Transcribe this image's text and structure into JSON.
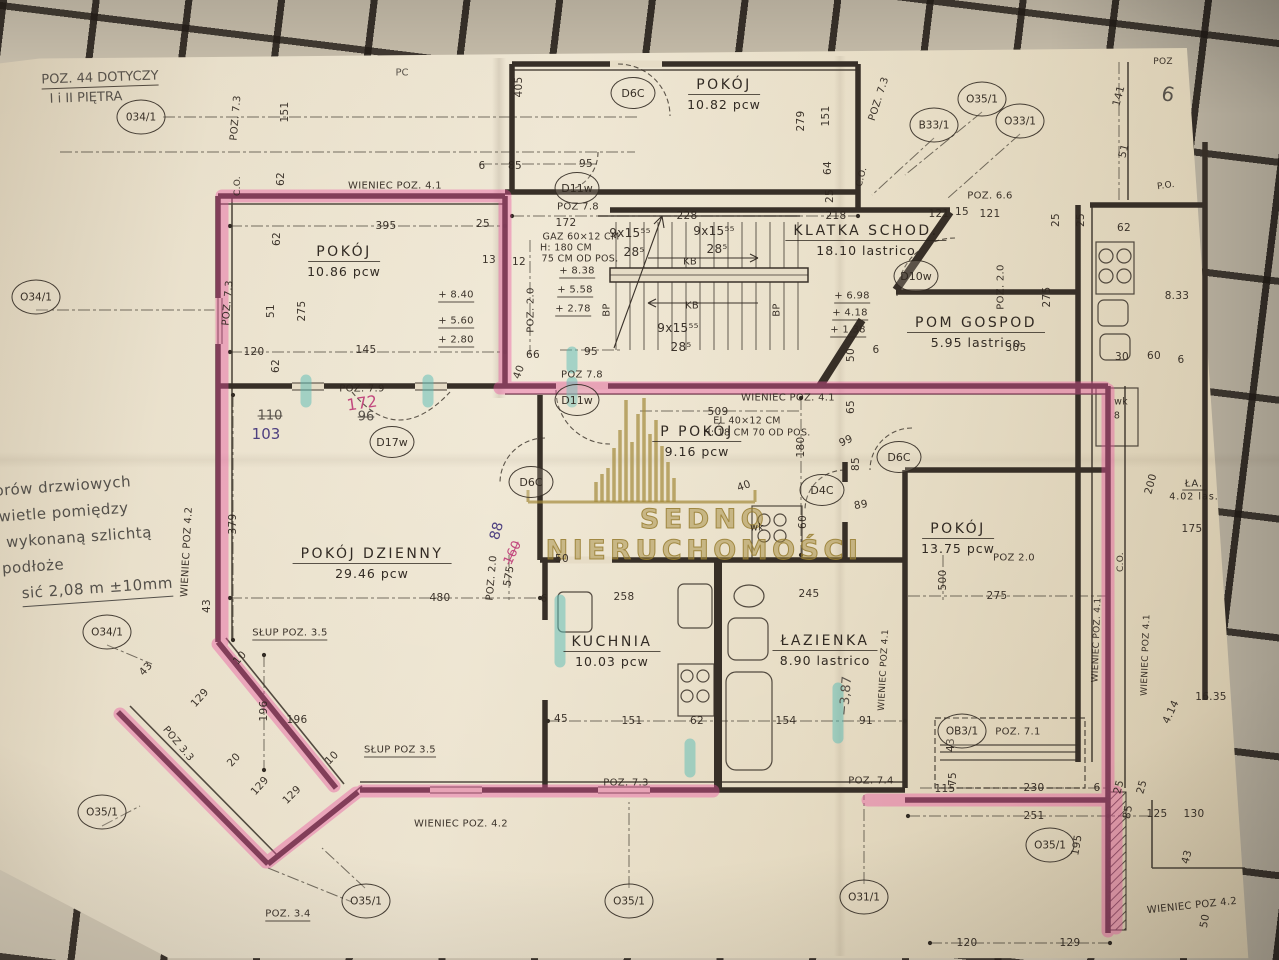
{
  "photo": {
    "paper_color": "#e6dcc6",
    "ink_color": "#332c24",
    "highlighter_pink": "#e954a0",
    "highlighter_teal": "#58bcb6",
    "watermark_gold": "#a58c3e",
    "cloth_color": "#d2c8b4"
  },
  "watermark": {
    "text": "SEDNO NIERUCHOMOŚCI",
    "icon": "building-skyline-icon"
  },
  "note_top": {
    "line1": "POZ. 44 DOTYCZY",
    "line2": "I i II PIĘTRA"
  },
  "margin_note": {
    "lines": [
      "orów drzwiowych",
      "świetle pomiędzy",
      "wykonaną szlichtą",
      "podłoże",
      "sić 2,08 m ±10mm"
    ],
    "indents": [
      6,
      0,
      14,
      8,
      26
    ]
  },
  "rooms": [
    {
      "name": "POKÓJ",
      "area": "10.82 pcw",
      "x": 724,
      "y": 93
    },
    {
      "name": "POKÓJ",
      "area": "10.86 pcw",
      "x": 344,
      "y": 260
    },
    {
      "name": "KLATKA SCHOD.",
      "area": "18.10 lastrico",
      "x": 866,
      "y": 239
    },
    {
      "name": "POM GOSPOD",
      "area": "5.95 lastrico",
      "x": 976,
      "y": 331
    },
    {
      "name": "P POKÓJ",
      "area": "9.16 pcw",
      "x": 697,
      "y": 440
    },
    {
      "name": "POKÓJ DZIENNY",
      "area": "29.46 pcw",
      "x": 372,
      "y": 562
    },
    {
      "name": "KUCHNIA",
      "area": "10.03 pcw",
      "x": 612,
      "y": 650
    },
    {
      "name": "ŁAZIENKA",
      "area": "8.90 lastrico",
      "x": 825,
      "y": 649
    },
    {
      "name": "POKÓJ",
      "area": "13.75 pcw",
      "x": 958,
      "y": 537
    },
    {
      "name": "ŁA.",
      "area": "4.02 las.",
      "x": 1194,
      "y": 487,
      "small": 1
    }
  ],
  "door_symbols": [
    {
      "label": "D6C",
      "x": 633,
      "y": 93
    },
    {
      "label": "D11w",
      "x": 577,
      "y": 188
    },
    {
      "label": "D10w",
      "x": 916,
      "y": 276
    },
    {
      "label": "D11w",
      "x": 577,
      "y": 400
    },
    {
      "label": "D17w",
      "x": 392,
      "y": 442
    },
    {
      "label": "D6C",
      "x": 531,
      "y": 482
    },
    {
      "label": "D4C",
      "x": 822,
      "y": 490
    },
    {
      "label": "D6C",
      "x": 899,
      "y": 457
    }
  ],
  "ref_symbols": [
    {
      "label": "034/1",
      "x": 141,
      "y": 117
    },
    {
      "label": "O34/1",
      "x": 36,
      "y": 297
    },
    {
      "label": "B33/1",
      "x": 934,
      "y": 125
    },
    {
      "label": "O35/1",
      "x": 982,
      "y": 99
    },
    {
      "label": "O33/1",
      "x": 1020,
      "y": 121
    },
    {
      "label": "O34/1",
      "x": 107,
      "y": 632
    },
    {
      "label": "O35/1",
      "x": 102,
      "y": 812
    },
    {
      "label": "O35/1",
      "x": 366,
      "y": 901
    },
    {
      "label": "O35/1",
      "x": 629,
      "y": 901
    },
    {
      "label": "O31/1",
      "x": 864,
      "y": 897
    },
    {
      "label": "OB3/1",
      "x": 962,
      "y": 731
    },
    {
      "label": "O35/1",
      "x": 1050,
      "y": 845
    }
  ],
  "annotations": [
    {
      "t": "WIENIEC POZ. 4.1",
      "x": 395,
      "y": 186
    },
    {
      "t": "WIENIEC POZ. 4.1",
      "x": 788,
      "y": 398
    },
    {
      "t": "WIENIEC POZ. 4.2",
      "x": 461,
      "y": 824
    },
    {
      "t": "WIENIEC POZ 4.2",
      "x": 187,
      "y": 552,
      "r": -87
    },
    {
      "t": "WIENIEC POZ 4.1",
      "x": 884,
      "y": 670,
      "r": -87,
      "fs": 9
    },
    {
      "t": "WIENIEC POZ. 4.1",
      "x": 1097,
      "y": 640,
      "r": -88,
      "fs": 9
    },
    {
      "t": "WIENIEC POZ 4.1",
      "x": 1146,
      "y": 655,
      "r": -88,
      "fs": 9
    },
    {
      "t": "WIENIEC POZ 4.2",
      "x": 1192,
      "y": 906,
      "r": -6
    },
    {
      "t": "POZ 7.8",
      "x": 578,
      "y": 207
    },
    {
      "t": "POZ 7.8",
      "x": 582,
      "y": 375
    },
    {
      "t": "POZ. 7.9",
      "x": 362,
      "y": 389
    },
    {
      "t": "POZ. 7.3",
      "x": 236,
      "y": 118,
      "r": -85
    },
    {
      "t": "POZ. 7.3",
      "x": 228,
      "y": 303,
      "r": -85
    },
    {
      "t": "POZ. 7.3",
      "x": 879,
      "y": 99,
      "r": -72
    },
    {
      "t": "POZ. 7.3",
      "x": 626,
      "y": 783
    },
    {
      "t": "POZ. 7.4",
      "x": 871,
      "y": 781
    },
    {
      "t": "POZ. 7.1",
      "x": 1018,
      "y": 732
    },
    {
      "t": "POZ. 6.6",
      "x": 990,
      "y": 196
    },
    {
      "t": "POZ. 2.0",
      "x": 531,
      "y": 310,
      "r": -90
    },
    {
      "t": "POZ. 2.0",
      "x": 1001,
      "y": 287,
      "r": -90
    },
    {
      "t": "POZ 2.0",
      "x": 1014,
      "y": 558
    },
    {
      "t": "POZ. 2.0",
      "x": 492,
      "y": 578,
      "r": -85
    },
    {
      "t": "SŁUP POZ. 3.5",
      "x": 290,
      "y": 634,
      "u": 1
    },
    {
      "t": "SŁUP POZ 3.5",
      "x": 400,
      "y": 751,
      "u": 1
    },
    {
      "t": "POZ 3.3",
      "x": 178,
      "y": 744,
      "r": 50
    },
    {
      "t": "POZ. 3.4",
      "x": 288,
      "y": 915,
      "u": 1
    },
    {
      "t": "GAZ 60×12 CM",
      "x": 581,
      "y": 237,
      "fs": 9.5
    },
    {
      "t": "H: 180 CM",
      "x": 566,
      "y": 248,
      "fs": 9.5
    },
    {
      "t": "75 CM OD POS.",
      "x": 580,
      "y": 259,
      "fs": 9.5
    },
    {
      "t": "EL 40×12 CM",
      "x": 747,
      "y": 421,
      "fs": 9.5
    },
    {
      "t": "H: 18 CM 70 OD POS.",
      "x": 757,
      "y": 433,
      "fs": 9.5
    },
    {
      "t": "+ 8.40",
      "x": 456,
      "y": 296,
      "u": 1
    },
    {
      "t": "+ 5.60",
      "x": 456,
      "y": 322,
      "u": 1
    },
    {
      "t": "+ 2.80",
      "x": 456,
      "y": 341,
      "u": 1
    },
    {
      "t": "+ 8.38",
      "x": 577,
      "y": 272,
      "u": 1
    },
    {
      "t": "+ 5.58",
      "x": 575,
      "y": 291,
      "u": 1
    },
    {
      "t": "+ 2.78",
      "x": 573,
      "y": 310,
      "u": 1
    },
    {
      "t": "+ 6.98",
      "x": 852,
      "y": 297,
      "u": 1
    },
    {
      "t": "+ 4.18",
      "x": 850,
      "y": 314,
      "u": 1
    },
    {
      "t": "+ 1.38",
      "x": 848,
      "y": 331,
      "u": 1
    },
    {
      "t": "9x15⁵⁵",
      "x": 630,
      "y": 233,
      "fs": 12
    },
    {
      "t": "9x15⁵⁵",
      "x": 714,
      "y": 231,
      "fs": 12
    },
    {
      "t": "9x15⁵⁵",
      "x": 678,
      "y": 328,
      "fs": 12
    },
    {
      "t": "28⁵",
      "x": 634,
      "y": 252,
      "fs": 12
    },
    {
      "t": "28⁵",
      "x": 717,
      "y": 249,
      "fs": 12
    },
    {
      "t": "28⁵",
      "x": 681,
      "y": 347,
      "fs": 12
    },
    {
      "t": "KB",
      "x": 690,
      "y": 262
    },
    {
      "t": "KB",
      "x": 692,
      "y": 306
    },
    {
      "t": "BP",
      "x": 607,
      "y": 310,
      "r": -90
    },
    {
      "t": "BP",
      "x": 777,
      "y": 310,
      "r": -90
    },
    {
      "t": "C.O.",
      "x": 238,
      "y": 186,
      "r": -90,
      "fs": 9
    },
    {
      "t": "C.O.",
      "x": 862,
      "y": 177,
      "r": -75,
      "fs": 9
    },
    {
      "t": "C.O.",
      "x": 1121,
      "y": 562,
      "r": -90,
      "fs": 9
    },
    {
      "t": "P.O.",
      "x": 1166,
      "y": 186,
      "r": -8,
      "fs": 9
    },
    {
      "t": "POZ",
      "x": 1163,
      "y": 62,
      "fs": 9
    },
    {
      "t": "wk",
      "x": 1121,
      "y": 402,
      "fs": 9.5
    },
    {
      "t": "8",
      "x": 1117,
      "y": 416,
      "fs": 9.5
    },
    {
      "t": "wk",
      "x": 757,
      "y": 528,
      "fs": 9.5
    }
  ],
  "dims": [
    [
      "405",
      519,
      87,
      -90
    ],
    [
      "6",
      482,
      166
    ],
    [
      "85",
      515,
      166
    ],
    [
      "95",
      586,
      164
    ],
    [
      "172",
      566,
      223
    ],
    [
      "228",
      687,
      216
    ],
    [
      "218",
      836,
      216
    ],
    [
      "279",
      801,
      121,
      -90
    ],
    [
      "151",
      826,
      116,
      -90
    ],
    [
      "64",
      828,
      168,
      -90
    ],
    [
      "25",
      830,
      196,
      -90
    ],
    [
      "121",
      939,
      214
    ],
    [
      "15",
      962,
      212
    ],
    [
      "121",
      990,
      214
    ],
    [
      "25",
      1056,
      220,
      -90
    ],
    [
      "25",
      1081,
      220,
      -90
    ],
    [
      "62",
      1124,
      228
    ],
    [
      "141",
      1119,
      96,
      -75
    ],
    [
      "51",
      1124,
      151,
      -75
    ],
    [
      "151",
      285,
      112,
      -90
    ],
    [
      "62",
      281,
      179,
      -90
    ],
    [
      "395",
      386,
      226
    ],
    [
      "25",
      483,
      224
    ],
    [
      "62",
      277,
      239,
      -90
    ],
    [
      "13",
      489,
      260
    ],
    [
      "12",
      519,
      262
    ],
    [
      "51",
      271,
      311,
      -90
    ],
    [
      "275",
      302,
      311,
      -90
    ],
    [
      "145",
      366,
      350
    ],
    [
      "120",
      254,
      352
    ],
    [
      "62",
      276,
      366,
      -90
    ],
    [
      "95",
      591,
      352
    ],
    [
      "66",
      533,
      355
    ],
    [
      "40",
      519,
      372,
      -70
    ],
    [
      "509",
      718,
      412
    ],
    [
      "65",
      851,
      407,
      -90
    ],
    [
      "99",
      846,
      441,
      -25
    ],
    [
      "180",
      801,
      447,
      -90
    ],
    [
      "85",
      856,
      464,
      -90
    ],
    [
      "40",
      744,
      486,
      -20
    ],
    [
      "89",
      861,
      505,
      -10
    ],
    [
      "60",
      803,
      522,
      -90
    ],
    [
      "379",
      233,
      524,
      -90
    ],
    [
      "480",
      440,
      598
    ],
    [
      "575",
      509,
      576,
      -80
    ],
    [
      "50",
      562,
      559
    ],
    [
      "6",
      544,
      599
    ],
    [
      "258",
      624,
      597
    ],
    [
      "245",
      809,
      594
    ],
    [
      "45",
      561,
      719
    ],
    [
      "151",
      632,
      721
    ],
    [
      "62",
      697,
      721
    ],
    [
      "154",
      786,
      721
    ],
    [
      "91",
      866,
      721
    ],
    [
      "196",
      264,
      711,
      -90
    ],
    [
      "196",
      297,
      720
    ],
    [
      "129",
      200,
      698,
      -48
    ],
    [
      "43",
      146,
      669,
      -48
    ],
    [
      "10",
      240,
      658,
      -48
    ],
    [
      "20",
      234,
      760,
      -48
    ],
    [
      "10",
      332,
      758,
      -45
    ],
    [
      "129",
      260,
      786,
      -48
    ],
    [
      "129",
      292,
      795,
      -45
    ],
    [
      "275",
      997,
      596
    ],
    [
      "500",
      943,
      580,
      -90
    ],
    [
      "275",
      1047,
      297,
      -90
    ],
    [
      "305",
      1016,
      348
    ],
    [
      "50",
      851,
      355,
      -90
    ],
    [
      "6",
      876,
      350
    ],
    [
      "30",
      1122,
      357
    ],
    [
      "60",
      1154,
      356
    ],
    [
      "6",
      1181,
      360
    ],
    [
      "230",
      1034,
      788
    ],
    [
      "251",
      1034,
      816
    ],
    [
      "6",
      1097,
      788
    ],
    [
      "25",
      1119,
      787,
      -75
    ],
    [
      "25",
      1142,
      787,
      -75
    ],
    [
      "115",
      945,
      789
    ],
    [
      "75",
      953,
      779,
      -90
    ],
    [
      "43",
      951,
      745,
      -90
    ],
    [
      "85",
      1128,
      812,
      -80
    ],
    [
      "125",
      1157,
      814
    ],
    [
      "130",
      1194,
      814
    ],
    [
      "120",
      967,
      943
    ],
    [
      "129",
      1070,
      943
    ],
    [
      "195",
      1077,
      845,
      -80
    ],
    [
      "43",
      1187,
      857,
      -75
    ],
    [
      "50",
      1205,
      921,
      -80
    ],
    [
      "175",
      1192,
      529
    ],
    [
      "200",
      1151,
      484,
      -75
    ],
    [
      "43",
      207,
      606,
      -90
    ],
    [
      "8.33",
      1177,
      296
    ],
    [
      "16.35",
      1211,
      697
    ],
    [
      "4.14",
      1171,
      712,
      -65
    ]
  ],
  "hand_marks": [
    {
      "t": "110",
      "x": 270,
      "y": 416,
      "c": "pencil",
      "strike": 1
    },
    {
      "t": "103",
      "x": 266,
      "y": 434,
      "c": "purple",
      "fs": 15
    },
    {
      "t": "172",
      "x": 362,
      "y": 403,
      "c": "pinkpen",
      "fs": 16,
      "r": -8
    },
    {
      "t": "96",
      "x": 366,
      "y": 417,
      "c": "pencil",
      "strike": 1
    },
    {
      "t": "88",
      "x": 497,
      "y": 531,
      "c": "purple",
      "r": -75,
      "fs": 14
    },
    {
      "t": "160",
      "x": 513,
      "y": 553,
      "c": "pinkpen",
      "r": -65,
      "strike": 1
    },
    {
      "t": "−3,87",
      "x": 846,
      "y": 696,
      "c": "pencil",
      "r": -85
    },
    {
      "t": "6",
      "x": 1168,
      "y": 94,
      "c": "pencil",
      "fs": 20,
      "r": 12
    },
    {
      "t": "PC",
      "x": 402,
      "y": 73,
      "c": "pencil",
      "fs": 10
    }
  ]
}
